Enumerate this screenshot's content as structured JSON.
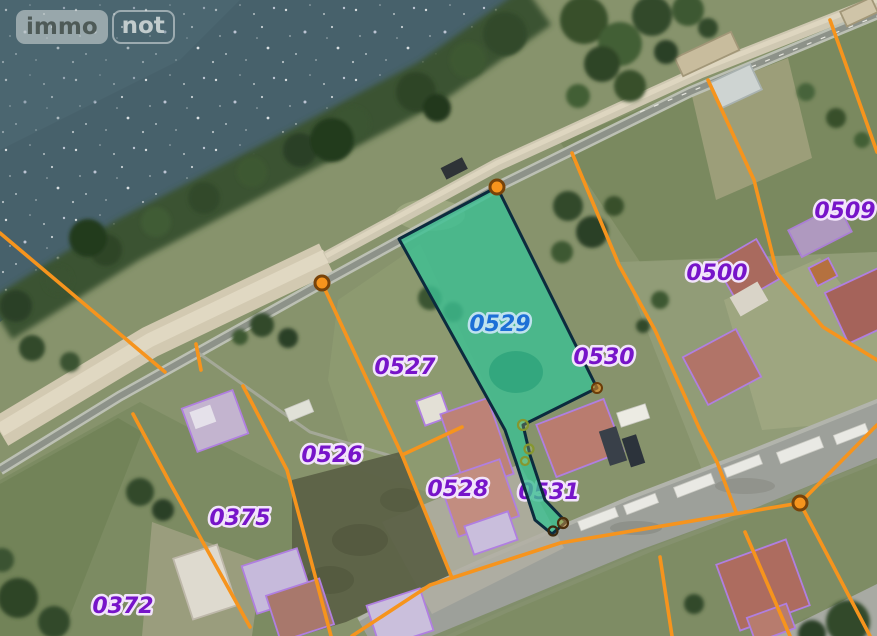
{
  "logo": {
    "immo": "immo",
    "not": "not"
  },
  "map": {
    "selected_parcel": "0529",
    "parcels": [
      {
        "id": "0529",
        "selected": true
      },
      {
        "id": "0527",
        "selected": false
      },
      {
        "id": "0530",
        "selected": false
      },
      {
        "id": "0526",
        "selected": false
      },
      {
        "id": "0528",
        "selected": false
      },
      {
        "id": "0531",
        "selected": false
      },
      {
        "id": "0375",
        "selected": false
      },
      {
        "id": "0372",
        "selected": false
      },
      {
        "id": "0500",
        "selected": false
      },
      {
        "id": "0509",
        "selected": false
      }
    ],
    "colors": {
      "boundary_orange": "#f6941d",
      "selected_fill": "#3ebf92",
      "selected_border": "#0c2b3e",
      "selected_label": "#1d6fd6",
      "parcel_label": "#7714c9",
      "building_outline": "#b07fe0",
      "water": "#47616b"
    }
  }
}
